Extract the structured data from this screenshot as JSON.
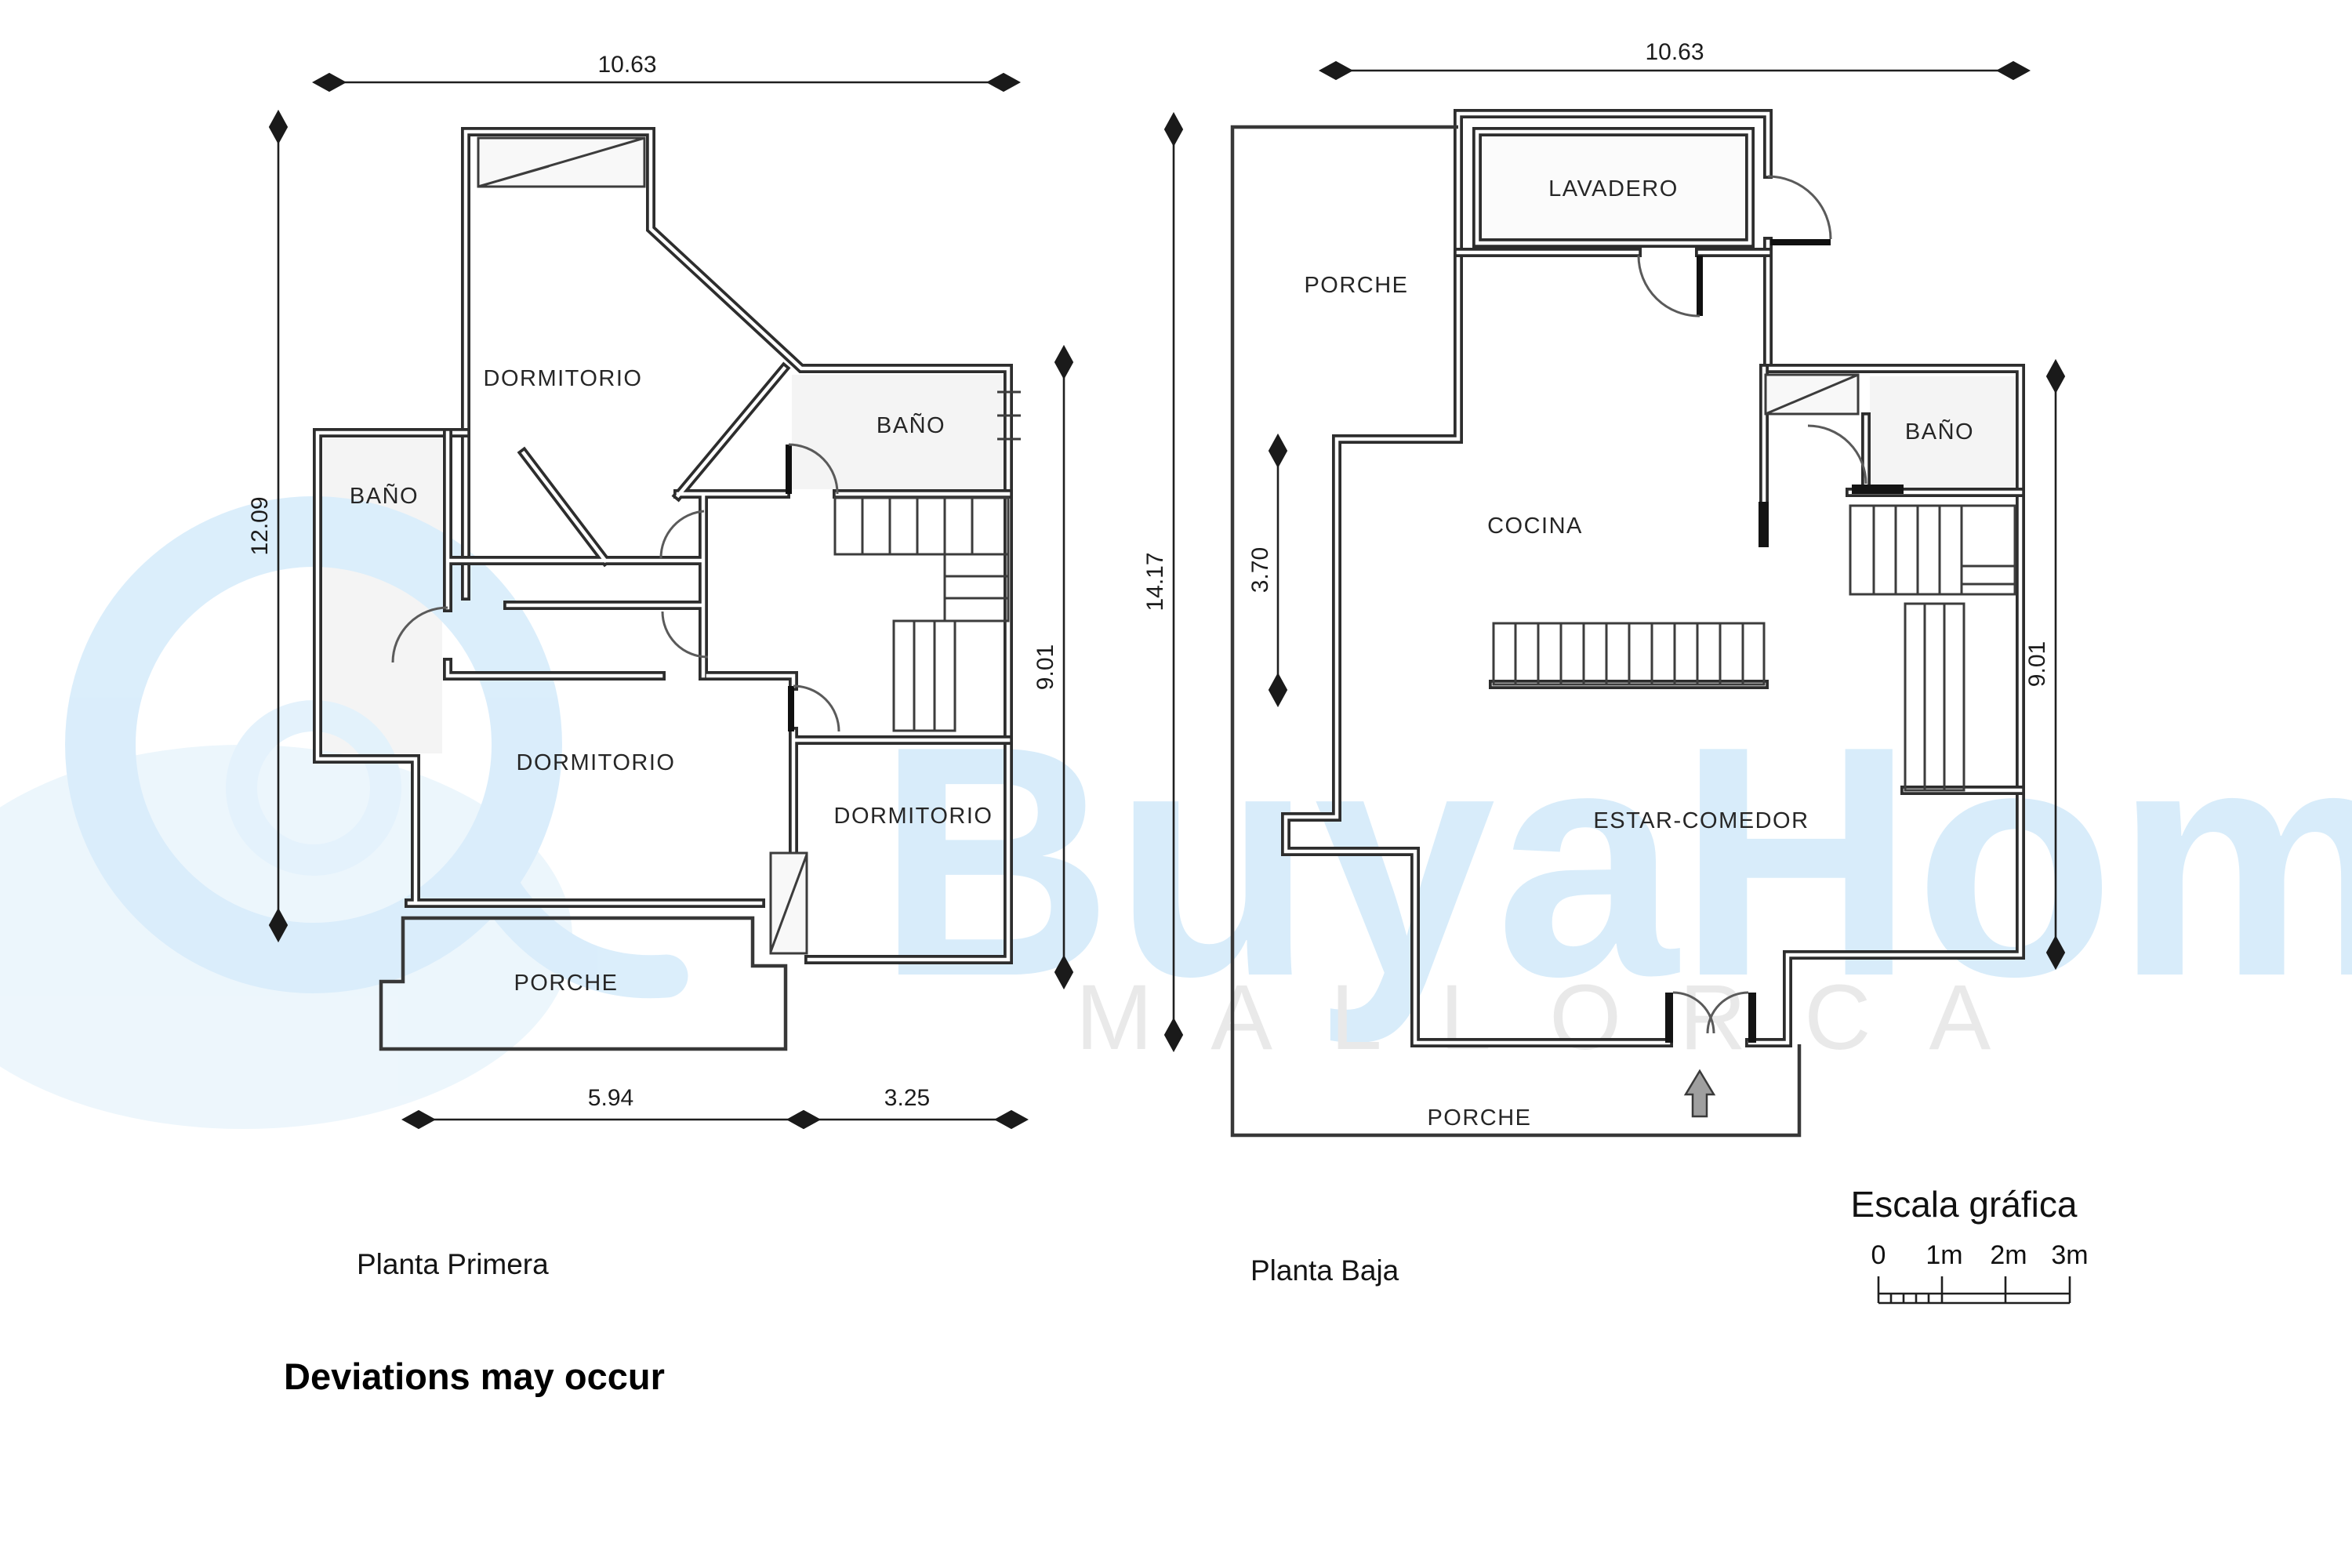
{
  "document": {
    "note": "Deviations may occur"
  },
  "watermark": {
    "brand": "BuyaHome",
    "location": "MALLORCA"
  },
  "plan_first_floor": {
    "title": "Planta Primera",
    "rooms": {
      "dormitorio_top": "DORMITORIO",
      "bano_left": "BAÑO",
      "bano_right": "BAÑO",
      "dormitorio_bottom_left": "DORMITORIO",
      "dormitorio_bottom_right": "DORMITORIO",
      "porche": "PORCHE"
    },
    "dimensions": {
      "width_top": "10.63",
      "height_left": "12.09",
      "height_right": "9.01",
      "bottom_left": "5.94",
      "bottom_right": "3.25"
    }
  },
  "plan_ground_floor": {
    "title": "Planta Baja",
    "rooms": {
      "lavadero": "LAVADERO",
      "porche_top": "PORCHE",
      "cocina": "COCINA",
      "bano": "BAÑO",
      "estar_comedor": "ESTAR-COMEDOR",
      "porche_bottom": "PORCHE"
    },
    "dimensions": {
      "width_top": "10.63",
      "height_left": "14.17",
      "kitchen_wall": "3.70",
      "height_right": "9.01"
    }
  },
  "scale_bar": {
    "title": "Escala gráfica",
    "tick_0": "0",
    "tick_1": "1m",
    "tick_2": "2m",
    "tick_3": "3m"
  }
}
